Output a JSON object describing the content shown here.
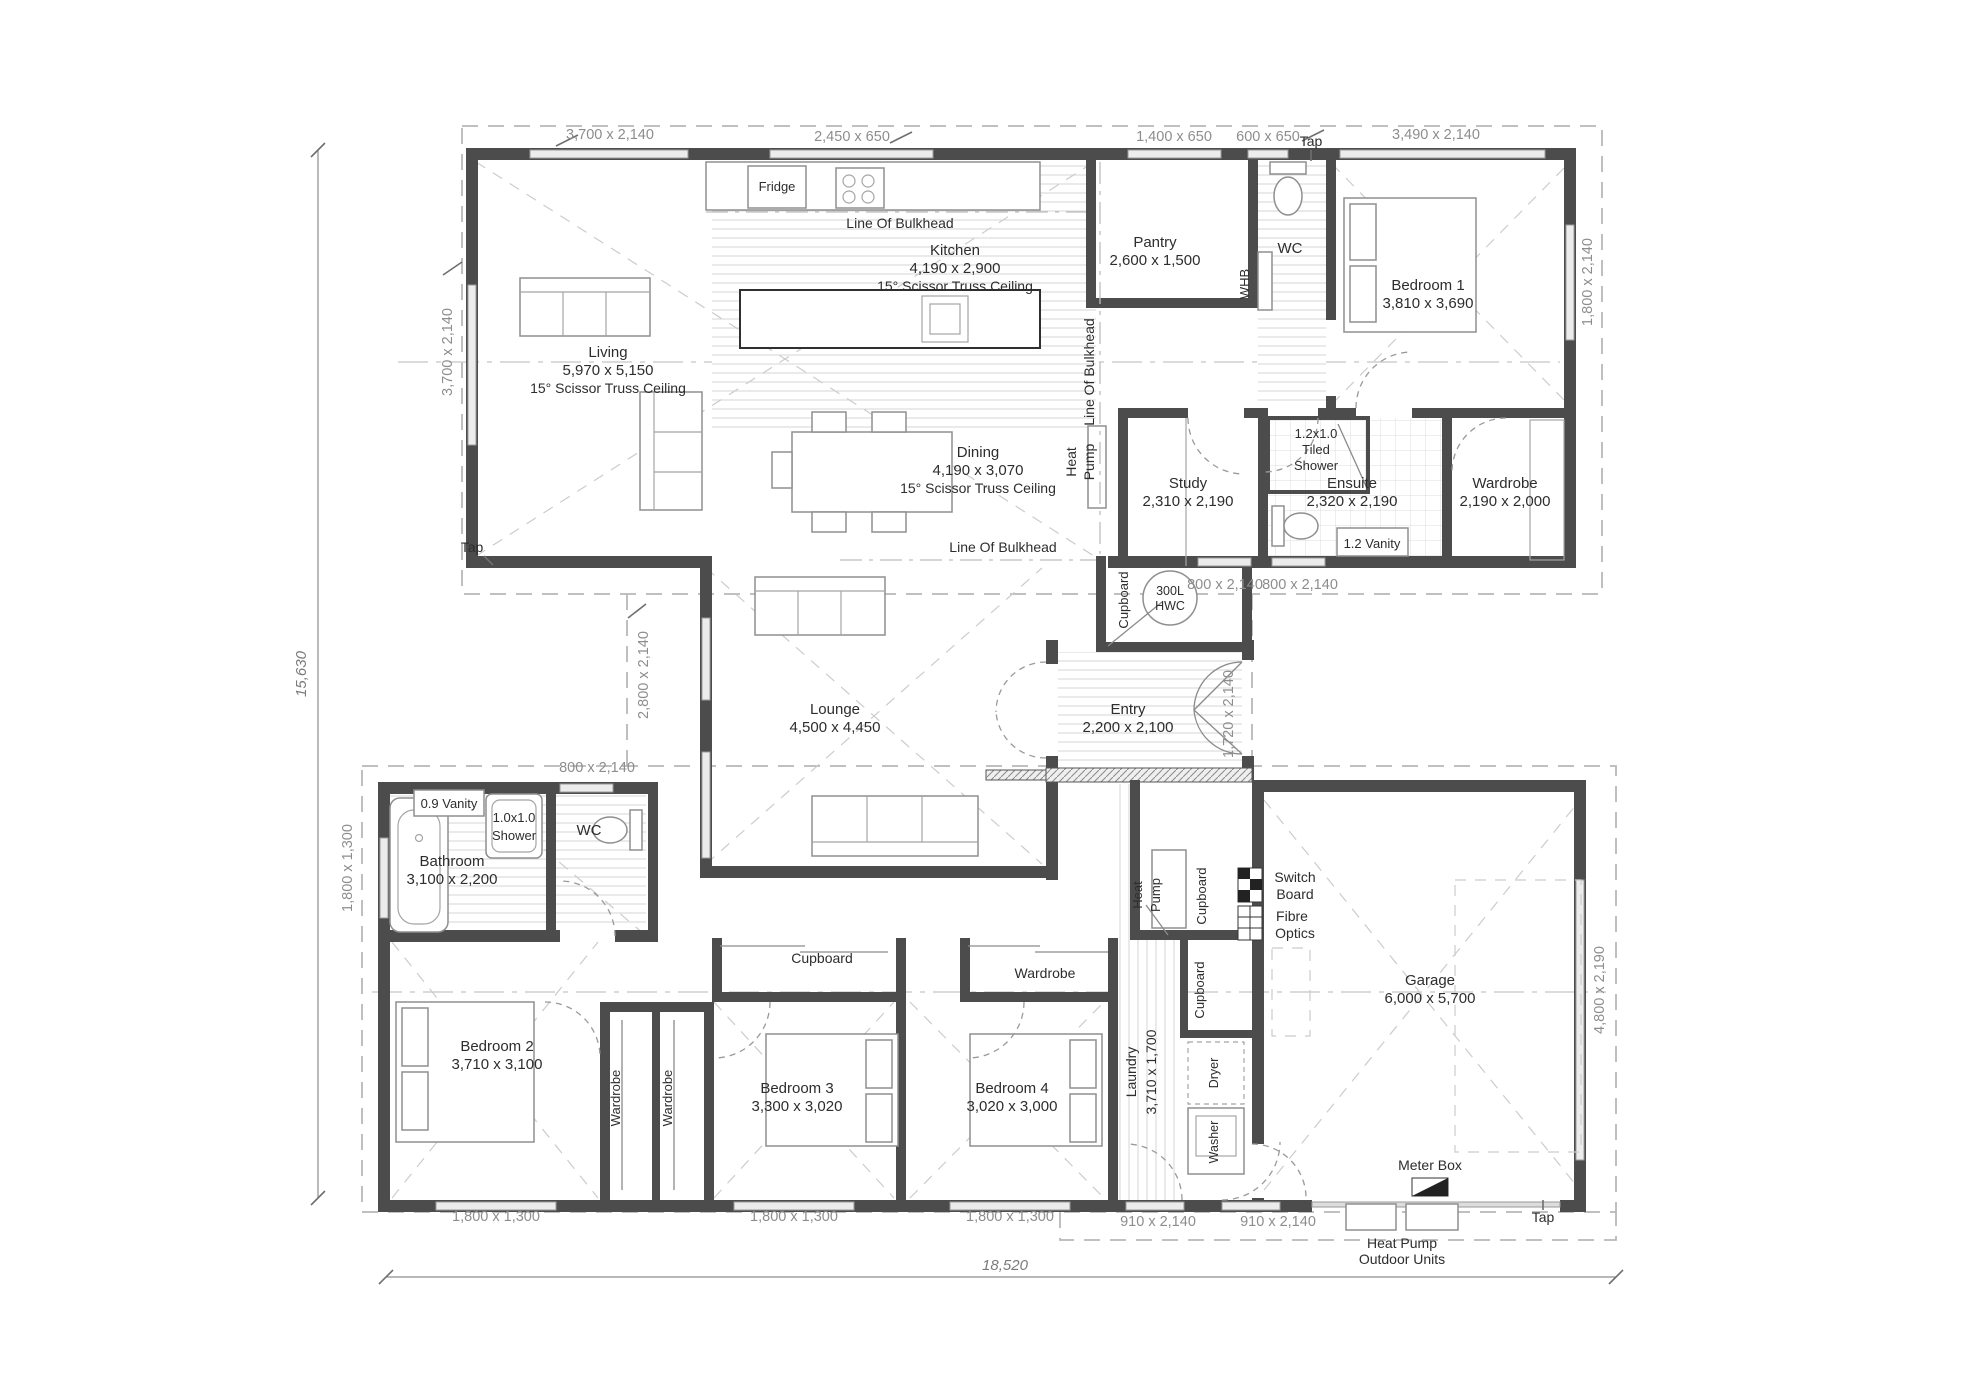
{
  "rooms": {
    "living": {
      "name": "Living",
      "dims": "5,970 x 5,150",
      "note": "15° Scissor Truss Ceiling"
    },
    "kitchen": {
      "name": "Kitchen",
      "dims": "4,190 x 2,900",
      "note": "15° Scissor Truss Ceiling"
    },
    "dining": {
      "name": "Dining",
      "dims": "4,190 x 3,070",
      "note": "15° Scissor Truss Ceiling"
    },
    "pantry": {
      "name": "Pantry",
      "dims": "2,600 x 1,500"
    },
    "wc_top": {
      "name": "WC"
    },
    "bedroom1": {
      "name": "Bedroom 1",
      "dims": "3,810 x 3,690"
    },
    "study": {
      "name": "Study",
      "dims": "2,310 x 2,190"
    },
    "tiled_shower": {
      "line1": "1.2x1.0",
      "line2": "Tiled",
      "line3": "Shower"
    },
    "ensuite": {
      "name": "Ensuite",
      "dims": "2,320 x 2,190"
    },
    "wardrobe_master": {
      "name": "Wardrobe",
      "dims": "2,190 x 2,000"
    },
    "vanity_ensuite": {
      "name": "1.2 Vanity"
    },
    "lounge": {
      "name": "Lounge",
      "dims": "4,500 x 4,450"
    },
    "entry": {
      "name": "Entry",
      "dims": "2,200 x 2,100"
    },
    "hwc": {
      "line1": "300L",
      "line2": "HWC"
    },
    "bathroom": {
      "name": "Bathroom",
      "dims": "3,100 x 2,200"
    },
    "vanity_bathroom": {
      "name": "0.9 Vanity"
    },
    "shower_bathroom": {
      "line1": "1.0x1.0",
      "line2": "Shower"
    },
    "wc_bottom": {
      "name": "WC"
    },
    "bedroom2": {
      "name": "Bedroom 2",
      "dims": "3,710 x 3,100"
    },
    "bedroom3": {
      "name": "Bedroom 3",
      "dims": "3,300 x 3,020"
    },
    "bedroom4": {
      "name": "Bedroom 4",
      "dims": "3,020 x 3,000"
    },
    "laundry": {
      "name": "Laundry",
      "dims": "3,710 x 1,700"
    },
    "garage": {
      "name": "Garage",
      "dims": "6,000 x 5,700"
    }
  },
  "fixtures": {
    "fridge": "Fridge",
    "whb": "WHB",
    "dryer": "Dryer",
    "washer": "Washer",
    "wardrobe_small": "Wardrobe",
    "cupboard": "Cupboard",
    "heat_pump": {
      "line1": "Heat",
      "line2": "Pump"
    },
    "switch_board": {
      "line1": "Switch",
      "line2": "Board"
    },
    "fibre_optics": {
      "line1": "Fibre",
      "line2": "Optics"
    },
    "meter_box": "Meter Box",
    "outdoor_units": {
      "line1": "Heat Pump",
      "line2": "Outdoor Units"
    }
  },
  "annotations": {
    "tap": "Tap",
    "line_of_bulkhead": "Line Of Bulkhead"
  },
  "dims": {
    "win_3700_2140": "3,700 x 2,140",
    "win_2450_650": "2,450 x 650",
    "win_1400_650": "1,400 x 650",
    "win_600_650": "600 x 650",
    "win_3490_2140": "3,490 x 2,140",
    "win_1800_2140": "1,800 x 2,140",
    "win_2800_2140": "2,800 x 2,140",
    "door_800": "800 x 2,140",
    "door_1720": "1,720 x 2,140",
    "win_1800_1300": "1,800 x 1,300",
    "door_910": "910 x 2,140",
    "win_4800_2190": "4,800 x 2,190",
    "overall_height": "15,630",
    "overall_width": "18,520"
  }
}
